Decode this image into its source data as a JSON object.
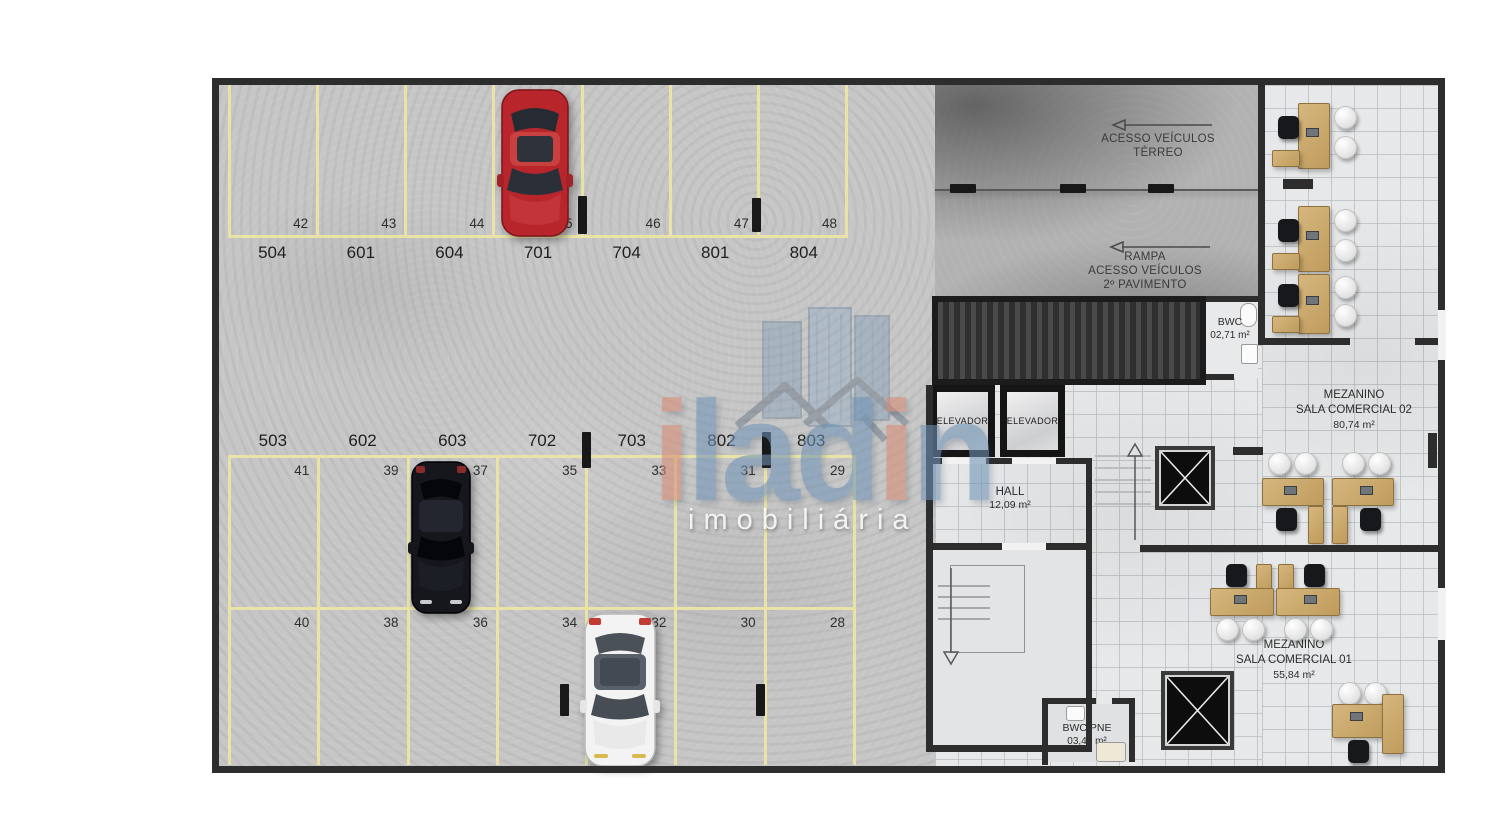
{
  "colors": {
    "wall": "#2d2d2d",
    "yellow": "#e9e4a6",
    "blue": "#6f93b5",
    "salmon": "#d78b74"
  },
  "watermark": {
    "p1": "i",
    "p2": "lad",
    "p3": "i",
    "p4": "n",
    "subtitle": "imobiliária"
  },
  "signs": {
    "terreo": {
      "l1": "ACESSO VEÍCULOS",
      "l2": "TÉRREO"
    },
    "rampa": {
      "l1": "RAMPA",
      "l2": "ACESSO VEÍCULOS",
      "l3": "2º PAVIMENTO"
    }
  },
  "garage": {
    "top": [
      {
        "spot": "42",
        "unit": "504"
      },
      {
        "spot": "43",
        "unit": "601"
      },
      {
        "spot": "44",
        "unit": "604"
      },
      {
        "spot": "45",
        "unit": "701"
      },
      {
        "spot": "46",
        "unit": "704"
      },
      {
        "spot": "47",
        "unit": "801"
      },
      {
        "spot": "48",
        "unit": "804"
      }
    ],
    "mid": [
      {
        "unit": "503",
        "spot": "41"
      },
      {
        "unit": "602",
        "spot": "39"
      },
      {
        "unit": "603",
        "spot": "37"
      },
      {
        "unit": "702",
        "spot": "35"
      },
      {
        "unit": "703",
        "spot": "33"
      },
      {
        "unit": "802",
        "spot": "31"
      },
      {
        "unit": "803",
        "spot": "29"
      }
    ],
    "bottom": [
      "40",
      "38",
      "36",
      "34",
      "32",
      "30",
      "28"
    ]
  },
  "mezzanine": {
    "bwc": {
      "title": "BWC",
      "area": "02,71 m²"
    },
    "elevators": [
      "ELEVADOR",
      "ELEVADOR"
    ],
    "hall": {
      "title": "HALL",
      "area": "12,09  m²"
    },
    "sala02": {
      "l1": "MEZANINO",
      "l2": "SALA COMERCIAL 02",
      "area": "80,74 m²"
    },
    "sala01": {
      "l1": "MEZANINO",
      "l2": "SALA COMERCIAL 01",
      "area": "55,84 m²"
    },
    "bwc_pne": {
      "title": "BWC PNE",
      "area": "03,44 m²"
    }
  }
}
